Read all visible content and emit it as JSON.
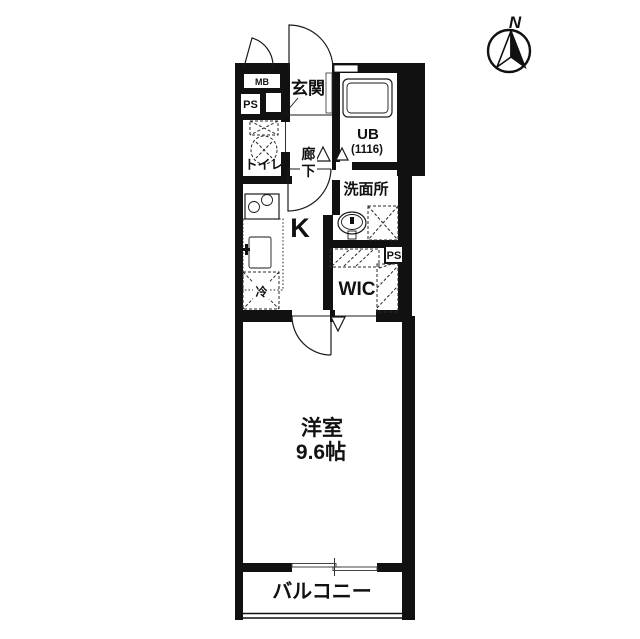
{
  "compass": {
    "label": "N"
  },
  "rooms": {
    "genkan": "玄関",
    "mb": "MB",
    "ps_top": "PS",
    "ps_right": "PS",
    "toilet": "トイレ",
    "corridor_char1": "廊",
    "corridor_char2": "下",
    "ub": "UB",
    "ub_size": "(1116)",
    "washroom": "洗面所",
    "kitchen": "K",
    "fridge": "冷",
    "wic": "WIC",
    "main_room": "洋室",
    "main_room_size": "9.6帖",
    "balcony": "バルコニー"
  },
  "colors": {
    "wall": "#111111",
    "background": "#ffffff"
  }
}
